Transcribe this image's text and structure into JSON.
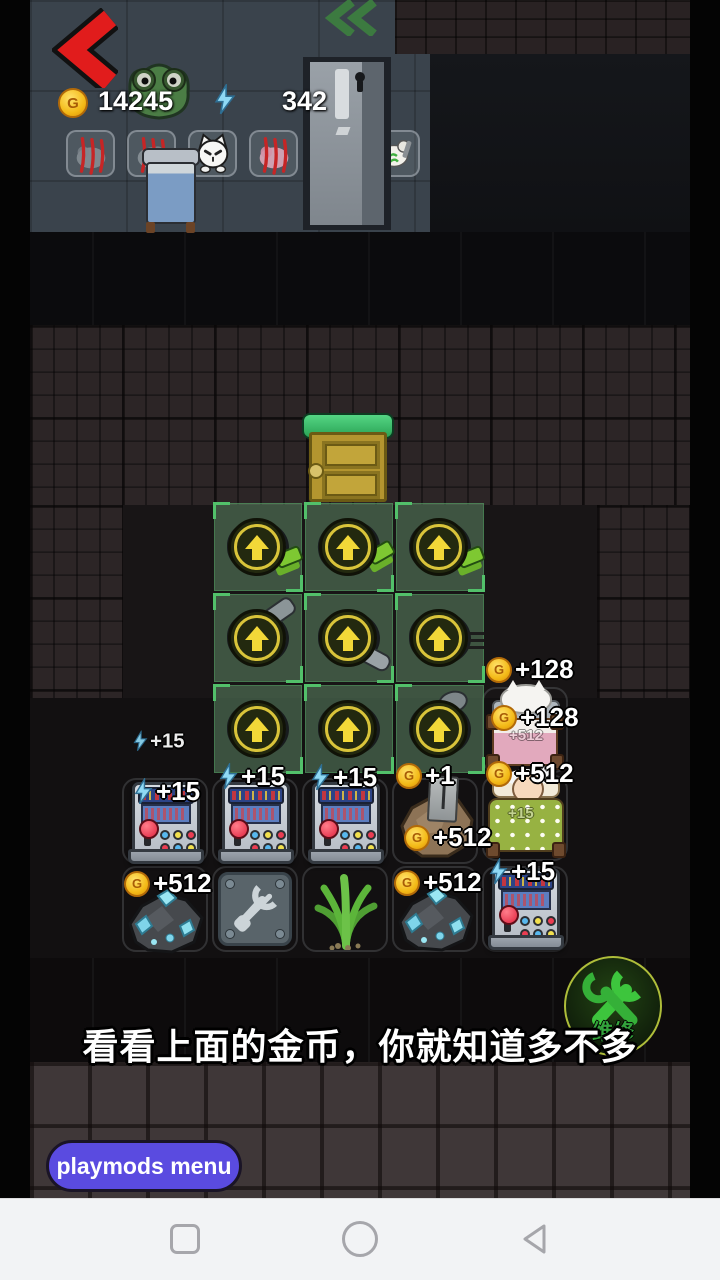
{
  "hud": {
    "gold_amount": "14245",
    "energy_amount": "342",
    "currency_letter": "G"
  },
  "gains": {
    "energy_15": "+15",
    "gold_512": "+512",
    "gold_128": "+128",
    "gold_1": "+1"
  },
  "repair_button": {
    "label": "维修"
  },
  "subtitle": {
    "text": "看看上面的金币，你就知道多不多"
  },
  "menu_button": {
    "label": "playmods menu"
  },
  "colors": {
    "back_red": "#e11c1c",
    "coin_gold": "#f6c321",
    "energy_blue": "#8fd9f5",
    "zone_green": "#52c06a",
    "door_green": "#2fb25c",
    "door_gold": "#b3952f",
    "repair_green": "#3dc53d",
    "menu_purple": "#5a4be0"
  }
}
